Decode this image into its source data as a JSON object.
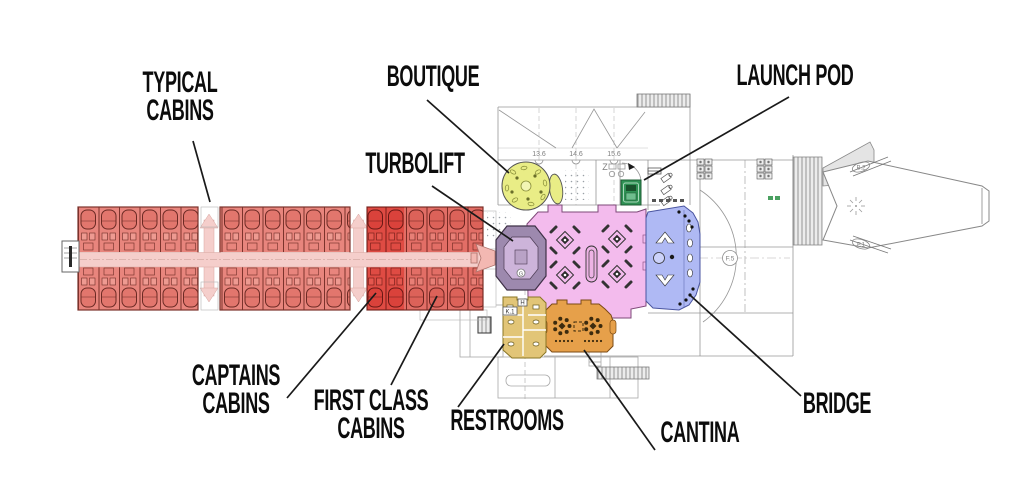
{
  "callouts": {
    "typical_cabins": "TYPICAL\nCABINS",
    "boutique": "BOUTIQUE",
    "turbolift": "TURBOLIFT",
    "launch_pod": "LAUNCH POD",
    "captains_cabins": "CAPTAINS\nCABINS",
    "first_class_cabins": "FIRST CLASS\nCABINS",
    "restrooms": "RESTROOMS",
    "cantina": "CANTINA",
    "bridge": "BRIDGE"
  },
  "plan_texts": {
    "grid_a": "13.6",
    "grid_b": "14.6",
    "grid_c": "15.6",
    "zone_z": "Z",
    "lift_g": "G",
    "rest_h": "H",
    "rest_k1": "K.1",
    "deck_f5": "F.5",
    "engine_b2": "B.2",
    "engine_f1": "F.1"
  },
  "colors": {
    "ink": "#111111",
    "blueprint_line": "#969696",
    "cabin": "#e8857d",
    "cabin_line": "#7c332c",
    "corridor": "#f5cecb",
    "captains": "#ee2013",
    "first_class": "#e85043",
    "hall": "#f3bbed",
    "hall_line": "#7e4878",
    "turbolift_ring": "#9d89ae",
    "turbolift_inner": "#cdb4da",
    "connector": "#f3b8b2",
    "boutique": "#e9ed86",
    "launch_pod": "#2f9154",
    "bridge": "#afb9f4",
    "bridge_line": "#4a55a0",
    "cantina": "#e6a04a",
    "restrooms": "#e2c577"
  }
}
